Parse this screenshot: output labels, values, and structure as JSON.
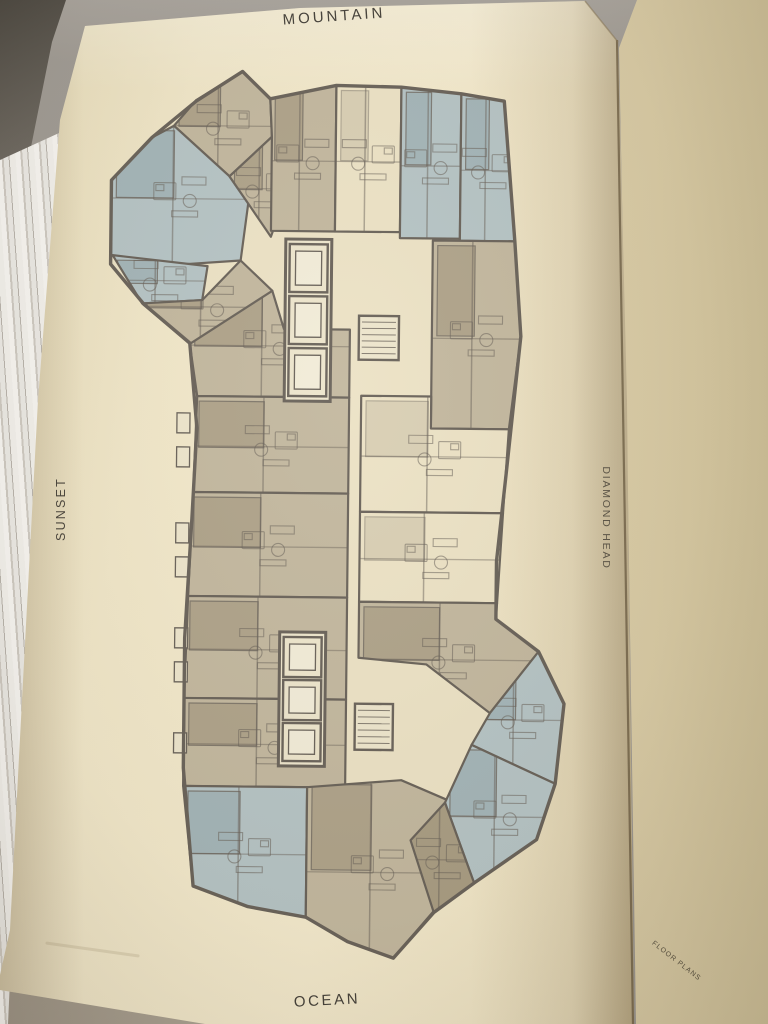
{
  "labels": {
    "top": "MOUNTAIN",
    "left": "SUNSET",
    "right": "DIAMOND HEAD",
    "bottom": "OCEAN",
    "corner": "FLOOR PLANS"
  },
  "colors": {
    "wall": "#6a635a",
    "tan": "#c3b89f",
    "tanDark": "#a99d83",
    "blue": "#b6c4c5",
    "blueDark": "#9eb1b3",
    "cream": "#ece2c5",
    "coreFill": "#ede5cc",
    "cabFill": "#f2ecd8",
    "balcony": "#d9cead",
    "ink": "#45413a"
  },
  "floor_plan": {
    "outline": "238,73 266,100 332,86 397,87 457,93 500,100 512,240 519,335 506,470 497,560 497,618 540,650 566,702 558,782 540,838 478,882 438,912 398,958 352,942 310,918 252,908 197,888 186,770 186,640 192,520 196,430 188,345 142,307 108,267 108,183 148,140 192,103",
    "units": [
      {
        "name": "wing-living-upper",
        "f": "tan",
        "p": "192,102 238,73 266,100 268,138 226,178 170,128"
      },
      {
        "name": "wing-master-suite",
        "f": "blue",
        "p": "108,183 148,140 170,128 226,178 245,205 238,262 160,268 108,258"
      },
      {
        "name": "wing-bedroom-lower",
        "f": "blue",
        "p": "110,258 205,268 200,302 140,306"
      },
      {
        "name": "wing-living-lower",
        "f": "tan",
        "p": "140,306 200,302 238,262 270,292 232,352 188,346"
      },
      {
        "name": "wing-bath-core",
        "f": "tan",
        "p": "226,178 268,138 292,168 268,238 245,205"
      },
      {
        "name": "top-unit-a",
        "f": "tan",
        "p": "266,100 332,86 332,232 268,232 268,138"
      },
      {
        "name": "top-unit-b",
        "f": "cream",
        "p": "332,86 397,87 397,232 332,232"
      },
      {
        "name": "top-unit-c",
        "f": "blue",
        "p": "397,87 457,93 457,238 397,238"
      },
      {
        "name": "top-corner-unit",
        "f": "blue",
        "p": "457,93 500,100 512,240 457,240"
      },
      {
        "name": "right-upper-unit",
        "f": "tan",
        "p": "430,240 512,240 519,335 508,428 430,428"
      },
      {
        "name": "right-mid-unit-a",
        "f": "cream",
        "p": "360,396 430,396 430,428 508,428 503,512 360,512"
      },
      {
        "name": "right-mid-unit-b",
        "f": "cream",
        "p": "360,512 503,512 498,602 360,602"
      },
      {
        "name": "right-lower-unit",
        "f": "tan",
        "p": "360,602 498,602 497,618 540,650 492,712 428,664 360,658"
      },
      {
        "name": "left-unit-top",
        "f": "tan",
        "p": "188,346 270,292 282,330 348,330 348,398 196,398"
      },
      {
        "name": "left-unit-a",
        "f": "tan",
        "p": "196,398 348,398 348,494 193,494"
      },
      {
        "name": "left-unit-b",
        "f": "tan",
        "p": "193,494 348,494 348,598 189,598"
      },
      {
        "name": "left-unit-c",
        "f": "tan",
        "p": "189,598 348,598 348,700 186,700"
      },
      {
        "name": "left-unit-d",
        "f": "tan",
        "p": "186,700 348,700 348,788 186,788"
      },
      {
        "name": "bottom-left-unit",
        "f": "blue",
        "p": "186,788 310,788 310,918 252,908 197,888"
      },
      {
        "name": "bottom-center-unit",
        "f": "tan",
        "p": "310,788 404,780 452,800 415,840 440,908 398,958 352,942 310,918"
      },
      {
        "name": "wing-br-upper",
        "f": "blue",
        "p": "540,650 566,702 558,782 474,744 492,712"
      },
      {
        "name": "wing-br-lower",
        "f": "blue",
        "p": "474,744 558,782 540,838 478,882 448,802"
      },
      {
        "name": "wing-br-bedroom",
        "f": "tanDark",
        "p": "448,802 478,882 438,912 414,840"
      }
    ],
    "balconies": [
      "496,242 512,242 517,335 506,468 497,468 508,335"
    ],
    "edge_boxes": [
      [
        176,
        415
      ],
      [
        176,
        449
      ],
      [
        176,
        525
      ],
      [
        176,
        559
      ],
      [
        176,
        630
      ],
      [
        176,
        664
      ],
      [
        176,
        735
      ]
    ],
    "elevator_banks": [
      {
        "surround": [
          283,
          240,
          46,
          162
        ],
        "cells": [
          [
            287,
            245,
            38,
            48
          ],
          [
            287,
            297,
            38,
            48
          ],
          [
            287,
            349,
            38,
            48
          ]
        ]
      },
      {
        "surround": [
          281,
          633,
          46,
          134
        ],
        "cells": [
          [
            285,
            638,
            38,
            40
          ],
          [
            285,
            681,
            38,
            40
          ],
          [
            285,
            724,
            38,
            38
          ]
        ]
      }
    ],
    "stairs": [
      [
        357,
        316,
        40,
        44
      ],
      [
        357,
        704,
        38,
        46
      ]
    ]
  }
}
